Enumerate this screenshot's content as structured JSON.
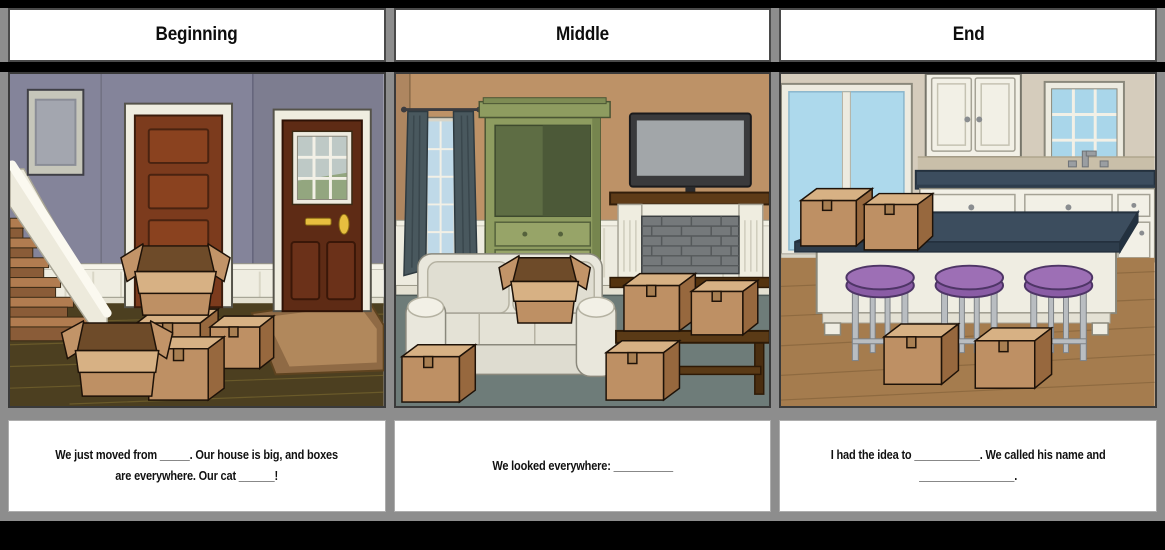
{
  "storyboard": {
    "panels": [
      {
        "title": "Beginning",
        "caption": "We just moved from _____. Our house is big, and boxes\nare everywhere. Our cat ______!",
        "scene": "entryway-hall-with-staircase-two-doors-and-stacked-moving-boxes"
      },
      {
        "title": "Middle",
        "caption": "We looked everywhere: __________",
        "scene": "living-room-with-sofa-tv-fireplace-armoire-and-moving-boxes"
      },
      {
        "title": "End",
        "caption": "I had the idea to ___________. We called his name and\n________________.",
        "scene": "kitchen-with-island-purple-stools-and-moving-boxes"
      }
    ],
    "colors": {
      "frame_gray": "#8D8D8D",
      "background_black": "#000000",
      "cardboard_top": "#D7B184",
      "cardboard_front": "#BE9064",
      "cardboard_side": "#97683E",
      "box_interior": "#6E4B29",
      "stool_purple": "#9D6FB5",
      "counter_slate": "#3C4D5E",
      "armoire_green": "#8E9C60",
      "wall_beginning_purple": "#84849A",
      "wall_middle_tan": "#BD9267",
      "wall_end_beige": "#D5CCBC"
    }
  }
}
